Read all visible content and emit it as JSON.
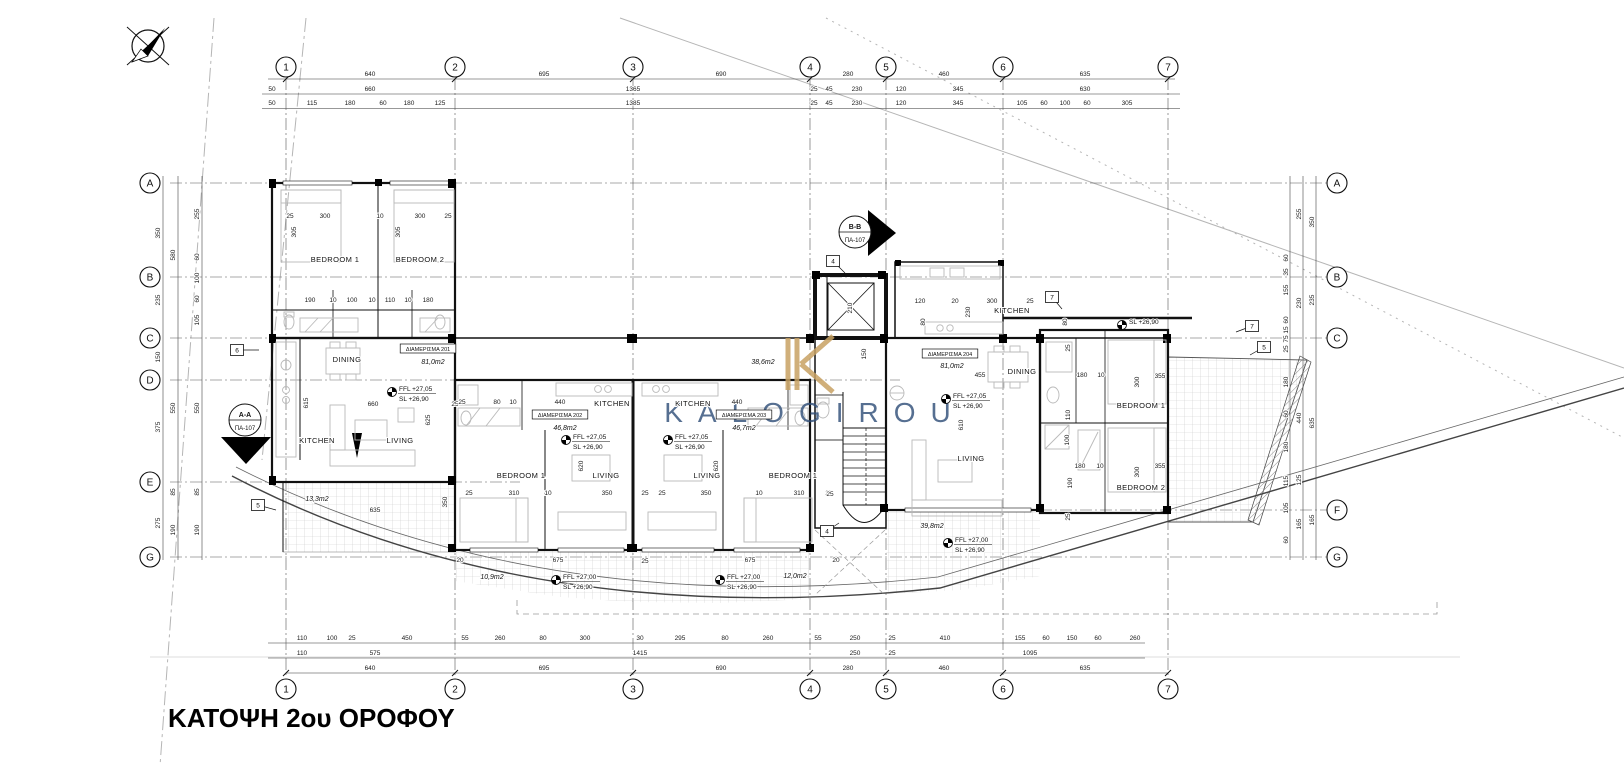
{
  "title": {
    "text": "ΚΑΤΟΨΗ 2ου ΟΡΟΦΟΥ"
  },
  "watermark": {
    "letter": "K",
    "name": "KALOGIROU",
    "navy": "#31507a",
    "gold": "#c8a263"
  },
  "grid": {
    "cols": [
      {
        "n": "1",
        "x": 286
      },
      {
        "n": "2",
        "x": 455
      },
      {
        "n": "3",
        "x": 633
      },
      {
        "n": "4",
        "x": 810
      },
      {
        "n": "5",
        "x": 886
      },
      {
        "n": "6",
        "x": 1003
      },
      {
        "n": "7",
        "x": 1168
      }
    ],
    "top_y": 67,
    "bottom_y": 689,
    "rows_left": [
      {
        "n": "A",
        "y": 183
      },
      {
        "n": "B",
        "y": 277
      },
      {
        "n": "C",
        "y": 338
      },
      {
        "n": "D",
        "y": 380,
        "x2": 900
      },
      {
        "n": "E",
        "y": 482,
        "x2": 520
      },
      {
        "n": "G",
        "y": 557
      }
    ],
    "rows_right": [
      {
        "n": "A",
        "y": 183
      },
      {
        "n": "B",
        "y": 277
      },
      {
        "n": "C",
        "y": 338
      },
      {
        "n": "F",
        "y": 510,
        "x1": 880
      },
      {
        "n": "G",
        "y": 557
      }
    ],
    "left_x": 150,
    "right_x": 1337
  },
  "units": [
    {
      "tag": "ΔΙΑΜΕΡΙΣΜΑ 201",
      "area": "81,0m2",
      "tx": 428,
      "ty": 351,
      "ax": 433,
      "ay": 364
    },
    {
      "tag": "ΔΙΑΜΕΡΙΣΜΑ 202",
      "area": "46,8m2",
      "tx": 560,
      "ty": 417,
      "ax": 565,
      "ay": 430
    },
    {
      "tag": "ΔΙΑΜΕΡΙΣΜΑ 203",
      "area": "46,7m2",
      "tx": 744,
      "ty": 417,
      "ax": 744,
      "ay": 430
    },
    {
      "tag": "ΔΙΑΜΕΡΙΣΜΑ 204",
      "area": "81,0m2",
      "tx": 950,
      "ty": 356,
      "ax": 952,
      "ay": 368
    }
  ],
  "rooms": [
    {
      "t": "BEDROOM 1",
      "x": 335,
      "y": 262
    },
    {
      "t": "BEDROOM 2",
      "x": 420,
      "y": 262
    },
    {
      "t": "DINING",
      "x": 347,
      "y": 362
    },
    {
      "t": "KITCHEN",
      "x": 317,
      "y": 443
    },
    {
      "t": "LIVING",
      "x": 400,
      "y": 443
    },
    {
      "t": "KITCHEN",
      "x": 612,
      "y": 406
    },
    {
      "t": "BEDROOM 1",
      "x": 521,
      "y": 478
    },
    {
      "t": "LIVING",
      "x": 606,
      "y": 478
    },
    {
      "t": "KITCHEN",
      "x": 693,
      "y": 406
    },
    {
      "t": "LIVING",
      "x": 707,
      "y": 478
    },
    {
      "t": "BEDROOM 1",
      "x": 793,
      "y": 478
    },
    {
      "t": "KITCHEN",
      "x": 1012,
      "y": 313
    },
    {
      "t": "DINING",
      "x": 1022,
      "y": 374
    },
    {
      "t": "LIVING",
      "x": 971,
      "y": 461
    },
    {
      "t": "BEDROOM 1",
      "x": 1141,
      "y": 408
    },
    {
      "t": "BEDROOM 2",
      "x": 1141,
      "y": 490
    }
  ],
  "areas": [
    {
      "t": "38,6m2",
      "x": 763,
      "y": 364
    },
    {
      "t": "13,3m2",
      "x": 317,
      "y": 501
    },
    {
      "t": "10,9m2",
      "x": 492,
      "y": 579
    },
    {
      "t": "12,0m2",
      "x": 795,
      "y": 578
    },
    {
      "t": "39,8m2",
      "x": 932,
      "y": 528
    }
  ],
  "levels": [
    {
      "l1": "FFL +27,05",
      "l2": "SL  +26,90",
      "x": 392,
      "y": 392
    },
    {
      "l1": "FFL +27,05",
      "l2": "SL  +26,90",
      "x": 566,
      "y": 440
    },
    {
      "l1": "FFL +27,05",
      "l2": "SL  +26,90",
      "x": 668,
      "y": 440
    },
    {
      "l1": "FFL +27,05",
      "l2": "SL  +26,90",
      "x": 946,
      "y": 399
    },
    {
      "l1": "FFL +27,00",
      "l2": "SL  +26,90",
      "x": 556,
      "y": 580
    },
    {
      "l1": "FFL +27,00",
      "l2": "SL  +26,90",
      "x": 720,
      "y": 580
    },
    {
      "l1": "FFL +27,00",
      "l2": "SL  +26,90",
      "x": 948,
      "y": 543
    },
    {
      "l1": "SL  +26,90",
      "l2": "",
      "x": 1122,
      "y": 325
    }
  ],
  "sections": [
    {
      "l1": "A-A",
      "l2": "ΠΑ-107"
    },
    {
      "l1": "B-B",
      "l2": "ΠΑ-107"
    }
  ],
  "keynotes": [
    {
      "n": "6",
      "x": 237,
      "y": 350,
      "ldx": 22,
      "ldy": 0
    },
    {
      "n": "5",
      "x": 258,
      "y": 505,
      "ldx": 18,
      "ldy": 5
    },
    {
      "n": "4",
      "x": 833,
      "y": 261,
      "ldx": 12,
      "ldy": 12
    },
    {
      "n": "4",
      "x": 827,
      "y": 531,
      "ldx": 12,
      "ldy": -8
    },
    {
      "n": "7",
      "x": 1052,
      "y": 297,
      "ldx": 10,
      "ldy": 12
    },
    {
      "n": "7",
      "x": 1252,
      "y": 326,
      "ldx": -16,
      "ldy": 6
    },
    {
      "n": "5",
      "x": 1264,
      "y": 347,
      "ldx": -14,
      "ldy": 8
    }
  ],
  "dims": [
    [
      "640",
      370,
      76,
      0
    ],
    [
      "695",
      544,
      76,
      0
    ],
    [
      "690",
      721,
      76,
      0
    ],
    [
      "280",
      848,
      76,
      0
    ],
    [
      "460",
      944,
      76,
      0
    ],
    [
      "635",
      1085,
      76,
      0
    ],
    [
      "50",
      272,
      91,
      0
    ],
    [
      "660",
      370,
      91,
      0
    ],
    [
      "1365",
      633,
      91,
      0
    ],
    [
      "25",
      814,
      91,
      0
    ],
    [
      "45",
      829,
      91,
      0
    ],
    [
      "230",
      857,
      91,
      0
    ],
    [
      "120",
      901,
      91,
      0
    ],
    [
      "345",
      958,
      91,
      0
    ],
    [
      "630",
      1085,
      91,
      0
    ],
    [
      "50",
      272,
      105,
      0
    ],
    [
      "115",
      312,
      105,
      0
    ],
    [
      "180",
      350,
      105,
      0
    ],
    [
      "60",
      383,
      105,
      0
    ],
    [
      "180",
      409,
      105,
      0
    ],
    [
      "125",
      440,
      105,
      0
    ],
    [
      "1385",
      633,
      105,
      0
    ],
    [
      "25",
      814,
      105,
      0
    ],
    [
      "45",
      829,
      105,
      0
    ],
    [
      "230",
      857,
      105,
      0
    ],
    [
      "120",
      901,
      105,
      0
    ],
    [
      "345",
      958,
      105,
      0
    ],
    [
      "105",
      1022,
      105,
      0
    ],
    [
      "60",
      1044,
      105,
      0
    ],
    [
      "100",
      1065,
      105,
      0
    ],
    [
      "60",
      1087,
      105,
      0
    ],
    [
      "305",
      1127,
      105,
      0
    ],
    [
      "110",
      302,
      640,
      0
    ],
    [
      "100",
      332,
      640,
      0
    ],
    [
      "25",
      352,
      640,
      0
    ],
    [
      "450",
      407,
      640,
      0
    ],
    [
      "55",
      465,
      640,
      0
    ],
    [
      "260",
      500,
      640,
      0
    ],
    [
      "80",
      543,
      640,
      0
    ],
    [
      "300",
      585,
      640,
      0
    ],
    [
      "30",
      640,
      640,
      0
    ],
    [
      "295",
      680,
      640,
      0
    ],
    [
      "80",
      725,
      640,
      0
    ],
    [
      "260",
      768,
      640,
      0
    ],
    [
      "55",
      818,
      640,
      0
    ],
    [
      "250",
      855,
      640,
      0
    ],
    [
      "25",
      892,
      640,
      0
    ],
    [
      "410",
      945,
      640,
      0
    ],
    [
      "155",
      1020,
      640,
      0
    ],
    [
      "60",
      1046,
      640,
      0
    ],
    [
      "150",
      1072,
      640,
      0
    ],
    [
      "60",
      1098,
      640,
      0
    ],
    [
      "260",
      1135,
      640,
      0
    ],
    [
      "110",
      302,
      655,
      0
    ],
    [
      "575",
      375,
      655,
      0
    ],
    [
      "1415",
      640,
      655,
      0
    ],
    [
      "250",
      855,
      655,
      0
    ],
    [
      "25",
      892,
      655,
      0
    ],
    [
      "1095",
      1030,
      655,
      0
    ],
    [
      "640",
      370,
      670,
      0
    ],
    [
      "695",
      544,
      670,
      0
    ],
    [
      "690",
      721,
      670,
      0
    ],
    [
      "280",
      848,
      670,
      0
    ],
    [
      "460",
      944,
      670,
      0
    ],
    [
      "635",
      1085,
      670,
      0
    ],
    [
      "350",
      160,
      233,
      1
    ],
    [
      "235",
      160,
      300,
      1
    ],
    [
      "150",
      160,
      357,
      1
    ],
    [
      "375",
      160,
      427,
      1
    ],
    [
      "275",
      160,
      523,
      1
    ],
    [
      "580",
      175,
      255,
      1
    ],
    [
      "550",
      175,
      408,
      1
    ],
    [
      "85",
      175,
      492,
      1
    ],
    [
      "190",
      175,
      530,
      1
    ],
    [
      "255",
      199,
      214,
      1
    ],
    [
      "60",
      199,
      257,
      1
    ],
    [
      "100",
      199,
      278,
      1
    ],
    [
      "60",
      199,
      299,
      1
    ],
    [
      "105",
      199,
      320,
      1
    ],
    [
      "550",
      199,
      408,
      1
    ],
    [
      "85",
      199,
      492,
      1
    ],
    [
      "190",
      199,
      530,
      1
    ],
    [
      "350",
      1314,
      222,
      1
    ],
    [
      "235",
      1314,
      300,
      1
    ],
    [
      "635",
      1314,
      423,
      1
    ],
    [
      "165",
      1314,
      520,
      1
    ],
    [
      "255",
      1301,
      214,
      1
    ],
    [
      "230",
      1301,
      303,
      1
    ],
    [
      "440",
      1301,
      418,
      1
    ],
    [
      "125",
      1301,
      480,
      1
    ],
    [
      "165",
      1301,
      524,
      1
    ],
    [
      "60",
      1288,
      258,
      1
    ],
    [
      "35",
      1288,
      272,
      1
    ],
    [
      "155",
      1288,
      290,
      1
    ],
    [
      "60",
      1288,
      320,
      1
    ],
    [
      "15",
      1288,
      330,
      1
    ],
    [
      "75",
      1288,
      339,
      1
    ],
    [
      "25",
      1288,
      349,
      1
    ],
    [
      "180",
      1288,
      382,
      1
    ],
    [
      "60",
      1288,
      414,
      1
    ],
    [
      "180",
      1288,
      447,
      1
    ],
    [
      "115",
      1288,
      481,
      1
    ],
    [
      "105",
      1288,
      508,
      1
    ],
    [
      "60",
      1288,
      540,
      1
    ],
    [
      "25",
      290,
      218,
      0
    ],
    [
      "300",
      325,
      218,
      0
    ],
    [
      "10",
      380,
      218,
      0
    ],
    [
      "300",
      420,
      218,
      0
    ],
    [
      "25",
      448,
      218,
      0
    ],
    [
      "305",
      296,
      232,
      1
    ],
    [
      "305",
      400,
      232,
      1
    ],
    [
      "190",
      310,
      302,
      0
    ],
    [
      "10",
      333,
      302,
      0
    ],
    [
      "100",
      352,
      302,
      0
    ],
    [
      "10",
      372,
      302,
      0
    ],
    [
      "110",
      390,
      302,
      0
    ],
    [
      "10",
      408,
      302,
      0
    ],
    [
      "180",
      428,
      302,
      0
    ],
    [
      "660",
      373,
      406,
      0
    ],
    [
      "25",
      455,
      406,
      0
    ],
    [
      "615",
      308,
      403,
      1
    ],
    [
      "625",
      430,
      420,
      1
    ],
    [
      "635",
      375,
      512,
      0
    ],
    [
      "350",
      447,
      502,
      1
    ],
    [
      "25",
      462,
      404,
      0
    ],
    [
      "80",
      497,
      404,
      0
    ],
    [
      "10",
      513,
      404,
      0
    ],
    [
      "440",
      560,
      404,
      0
    ],
    [
      "620",
      583,
      466,
      1
    ],
    [
      "25",
      469,
      495,
      0
    ],
    [
      "310",
      514,
      495,
      0
    ],
    [
      "10",
      548,
      495,
      0
    ],
    [
      "350",
      607,
      495,
      0
    ],
    [
      "25",
      645,
      495,
      0
    ],
    [
      "440",
      737,
      404,
      0
    ],
    [
      "620",
      718,
      466,
      1
    ],
    [
      "25",
      662,
      495,
      0
    ],
    [
      "350",
      706,
      495,
      0
    ],
    [
      "10",
      759,
      495,
      0
    ],
    [
      "310",
      799,
      495,
      0
    ],
    [
      "25",
      829,
      495,
      0
    ],
    [
      "150",
      866,
      354,
      1
    ],
    [
      "210",
      852,
      308,
      1
    ],
    [
      "120",
      920,
      303,
      0
    ],
    [
      "20",
      955,
      303,
      0
    ],
    [
      "300",
      992,
      303,
      0
    ],
    [
      "25",
      1030,
      303,
      0
    ],
    [
      "80",
      925,
      322,
      1
    ],
    [
      "230",
      970,
      312,
      1
    ],
    [
      "455",
      980,
      377,
      0
    ],
    [
      "610",
      963,
      425,
      1
    ],
    [
      "80",
      1067,
      322,
      1
    ],
    [
      "180",
      1082,
      377,
      0
    ],
    [
      "10",
      1101,
      377,
      0
    ],
    [
      "355",
      1160,
      378,
      0
    ],
    [
      "300",
      1139,
      382,
      1
    ],
    [
      "25",
      1070,
      348,
      1
    ],
    [
      "110",
      1070,
      415,
      1
    ],
    [
      "100",
      1069,
      440,
      1
    ],
    [
      "190",
      1072,
      483,
      1
    ],
    [
      "180",
      1080,
      468,
      0
    ],
    [
      "10",
      1100,
      468,
      0
    ],
    [
      "355",
      1160,
      468,
      0
    ],
    [
      "300",
      1139,
      472,
      1
    ],
    [
      "20",
      460,
      562,
      0
    ],
    [
      "675",
      558,
      562,
      0
    ],
    [
      "25",
      645,
      563,
      0
    ],
    [
      "675",
      750,
      562,
      0
    ],
    [
      "20",
      836,
      562,
      0
    ],
    [
      "25",
      830,
      496,
      0
    ],
    [
      "25",
      1070,
      517,
      1
    ]
  ]
}
